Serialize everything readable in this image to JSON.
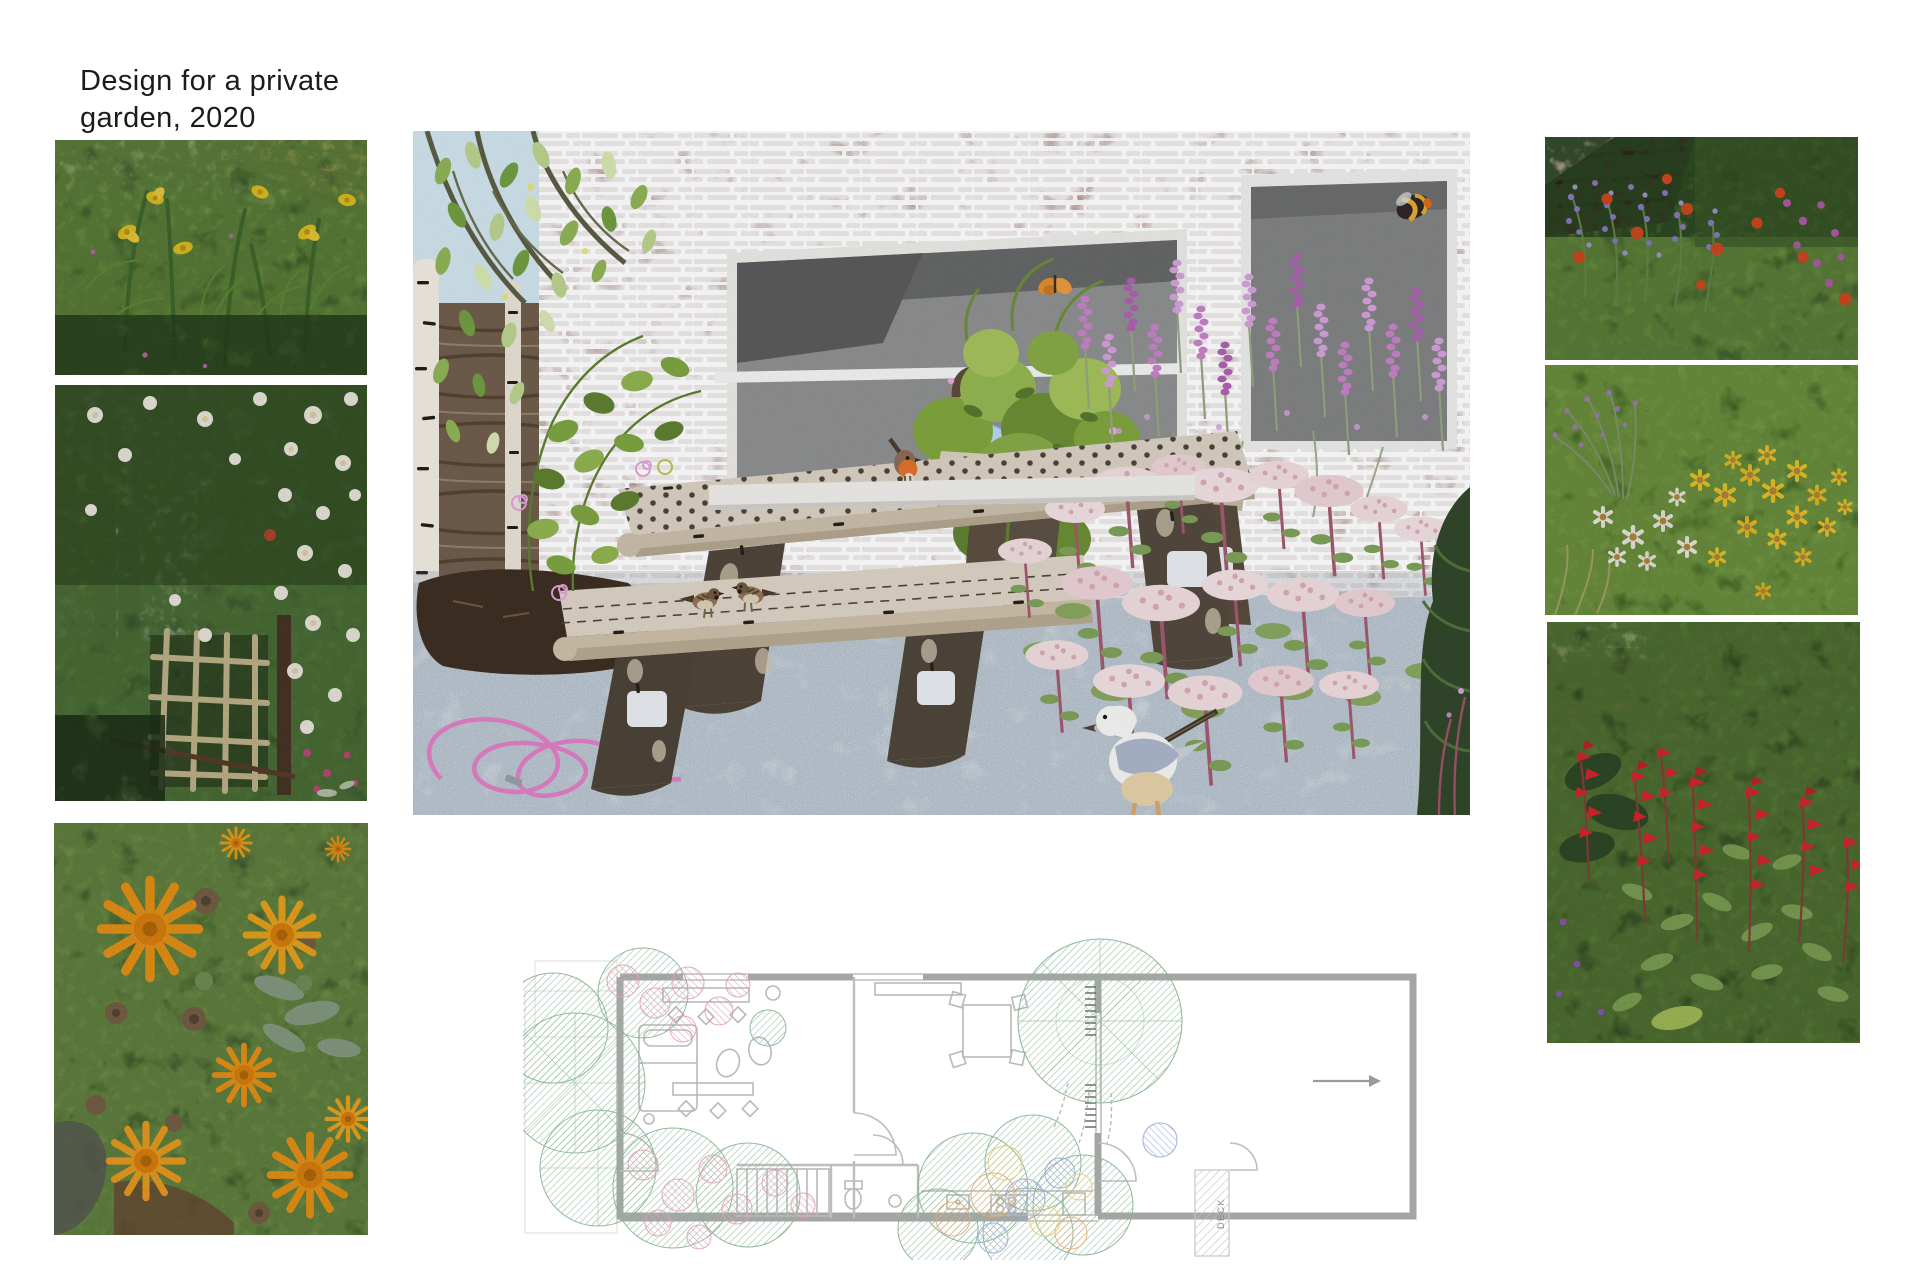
{
  "page": {
    "title": {
      "line1": "Design for a private",
      "line2": "garden, 2020"
    },
    "background_color": "#ffffff",
    "title_color": "#1b1b1b"
  },
  "artwork": {
    "illustration": {
      "label": "Collage illustration of the proposed courtyard garden: a birch-log picnic table with benches, two house sparrows and a robin, a boy in a blue hoodie watching from a large picture window in a whitewashed brick wall, a bumblebee, a butterfly, lavender and sedum planting, a seagull carrying a twig, and a pink garden hose coiled on stone paving",
      "palette": {
        "sky": "#cfe2ea",
        "brick_mortar": "#f5f1ec",
        "brick": "#6e3a33",
        "window_interior": "#8d8d8d",
        "hoodie_blue": "#b3d7ef",
        "wood_light": "#d9cec0",
        "wood_dark": "#4e4236",
        "lavender": "#c77fc6",
        "sedum_pink": "#eedadb",
        "pavement": "#e7eaee",
        "hose_pink": "#e07cc2"
      }
    },
    "floor_plan": {
      "label": "Ground-floor plan of the terraced house with front and rear gardens; planting drawn as hatched circles, deck to the rear",
      "deck_label": "DECK",
      "wall_color": "#a5a5a5",
      "planting_green": "#88b493"
    },
    "photos": {
      "left": [
        {
          "label": "Yellow flag irises among ferns in a shady border",
          "palette": [
            "#52703c",
            "#e8c522",
            "#2e4a26"
          ]
        },
        {
          "label": "White climbing roses over a trellis arch by the back door",
          "palette": [
            "#33502b",
            "#f3efe6",
            "#c6b98f"
          ]
        },
        {
          "label": "Orange calendula (pot marigold) flowers",
          "palette": [
            "#f09616",
            "#57793b",
            "#7a6148"
          ]
        }
      ],
      "right": [
        {
          "label": "Purple catmint and red geum in a sunny border by a dark shed",
          "palette": [
            "#8f7fc9",
            "#d84a20",
            "#4f7434"
          ]
        },
        {
          "label": "Yellow coreopsis and white daisies with lavender",
          "palette": [
            "#f0c829",
            "#f2efe6",
            "#5c8038"
          ]
        },
        {
          "label": "Red pineapple sage flower spikes against a green hedge",
          "palette": [
            "#e02430",
            "#3f6030",
            "#9a8874"
          ]
        }
      ]
    }
  }
}
